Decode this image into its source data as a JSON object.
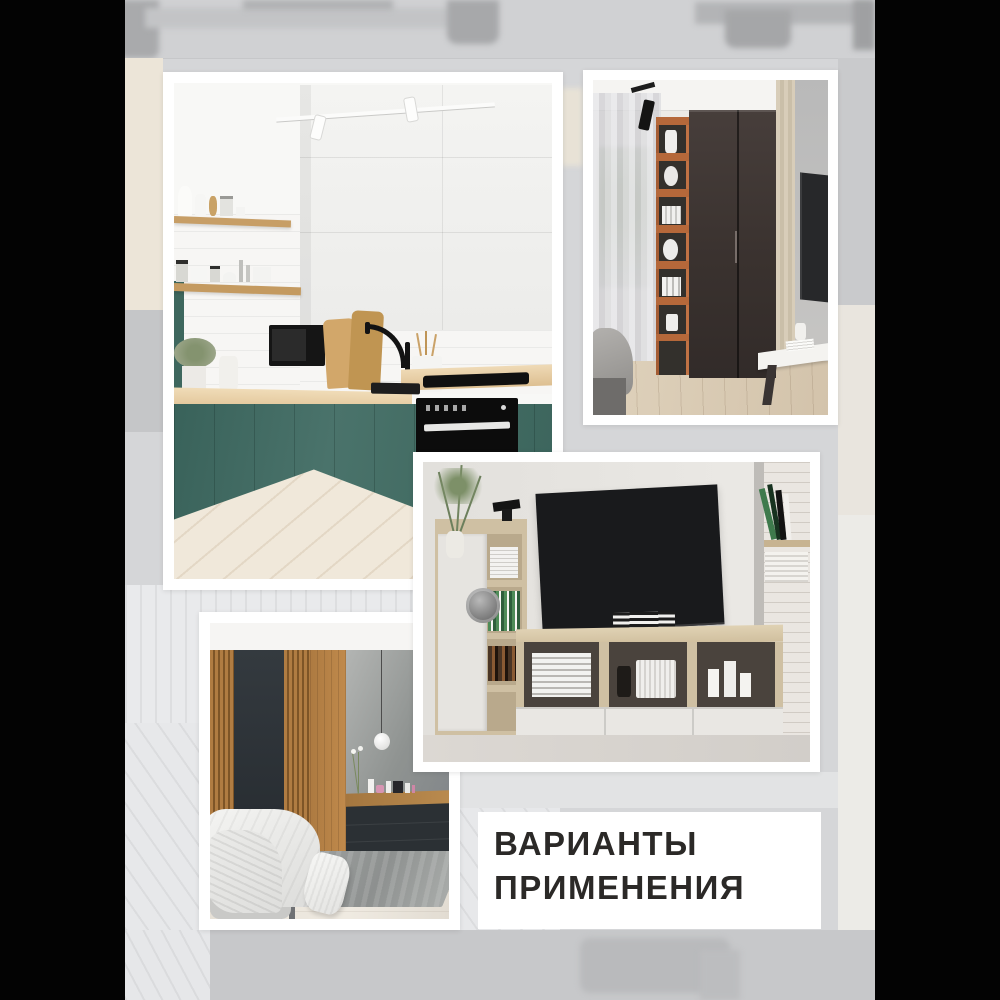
{
  "caption": {
    "line1": "ВАРИАНТЫ",
    "line2": "ПРИМЕНЕНИЯ",
    "text_color": "#2b2927",
    "box_color": "#ffffff"
  },
  "photos": [
    {
      "id": "kitchen",
      "description": "Corner kitchen: dark-green lower cabinets, white upper cabinets, oak worktop and open oak shelves with white dishware, black built-in oven, black faucet, whitewashed wood floor, white track spotlights"
    },
    {
      "id": "wardrobe-room",
      "description": "Bedroom corner: tall dark-brown two-door wardrobe, orange open shelving column with white decor, sheer curtains at window, black track spot, wall TV and white floating console"
    },
    {
      "id": "tv-lounge",
      "description": "Living room: wall-mounted TV above long light-oak media bench with white drawers, side cabinet with books and plant, white brick pillar with book shelves"
    },
    {
      "id": "bedroom",
      "description": "Bedroom: oak slat and graphite wall panels, concrete accent wall with white globe pendant, wood dressing shelf with cosmetics over dark drawers, white bed, floor pillow and grey rug"
    }
  ],
  "palette": {
    "pillarbox": "#030303",
    "backdrop_grey": "#d5d6d8",
    "frame_white": "#ffffff",
    "kitchen_green": "#446c63",
    "counter_oak": "#e2c89f",
    "wardrobe_brown": "#3b3330",
    "shelf_orange": "#b5683a",
    "tv_black": "#1b1c1e",
    "stand_oak": "#d4c4a6",
    "slat_oak": "#ad7a41",
    "panel_graphite": "#2e3338",
    "concrete_grey": "#9a9d9b"
  }
}
